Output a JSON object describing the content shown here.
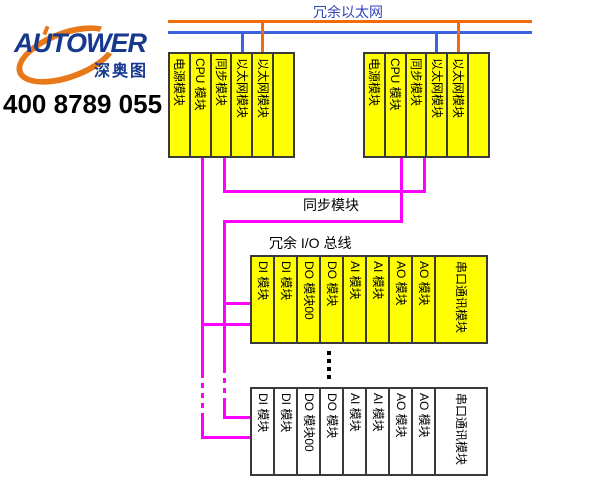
{
  "branding": {
    "logo": "AUTOWER",
    "logo_cn": "深奥图",
    "phone": "400 8789 055"
  },
  "labels": {
    "ethernet_bus": "冗余以太网",
    "sync_link": "同步模块",
    "io_bus": "冗余 I/O 总线"
  },
  "colors": {
    "ethernet_orange": "#F26A0A",
    "ethernet_blue": "#3E63E0",
    "io_bus_magenta": "#FF00FF",
    "module_yellow": "#FFFF00",
    "logo_navy": "#16388E",
    "logo_orange": "#E8791A",
    "label_blue": "#3344BB",
    "rack_border": "#3a3a3a"
  },
  "racks": {
    "controller_left": {
      "modules": [
        "电源模块",
        "CPU 模块",
        "同步模块",
        "以太网模块",
        "以太网模块",
        ""
      ]
    },
    "controller_right": {
      "modules": [
        "电源模块",
        "CPU 模块",
        "同步模块",
        "以太网模块",
        "以太网模块",
        ""
      ]
    },
    "io_top": {
      "modules": [
        "DI 模块",
        "DI 模块",
        "DO 模块00",
        "DO 模块",
        "AI 模块",
        "AI 模块",
        "AO 模块",
        "AO 模块",
        "串口通讯模块"
      ]
    },
    "io_bottom": {
      "modules": [
        "DI 模块",
        "DI 模块",
        "DO 模块00",
        "DO 模块",
        "AI 模块",
        "AI 模块",
        "AO 模块",
        "AO 模块",
        "串口通讯模块"
      ]
    }
  }
}
